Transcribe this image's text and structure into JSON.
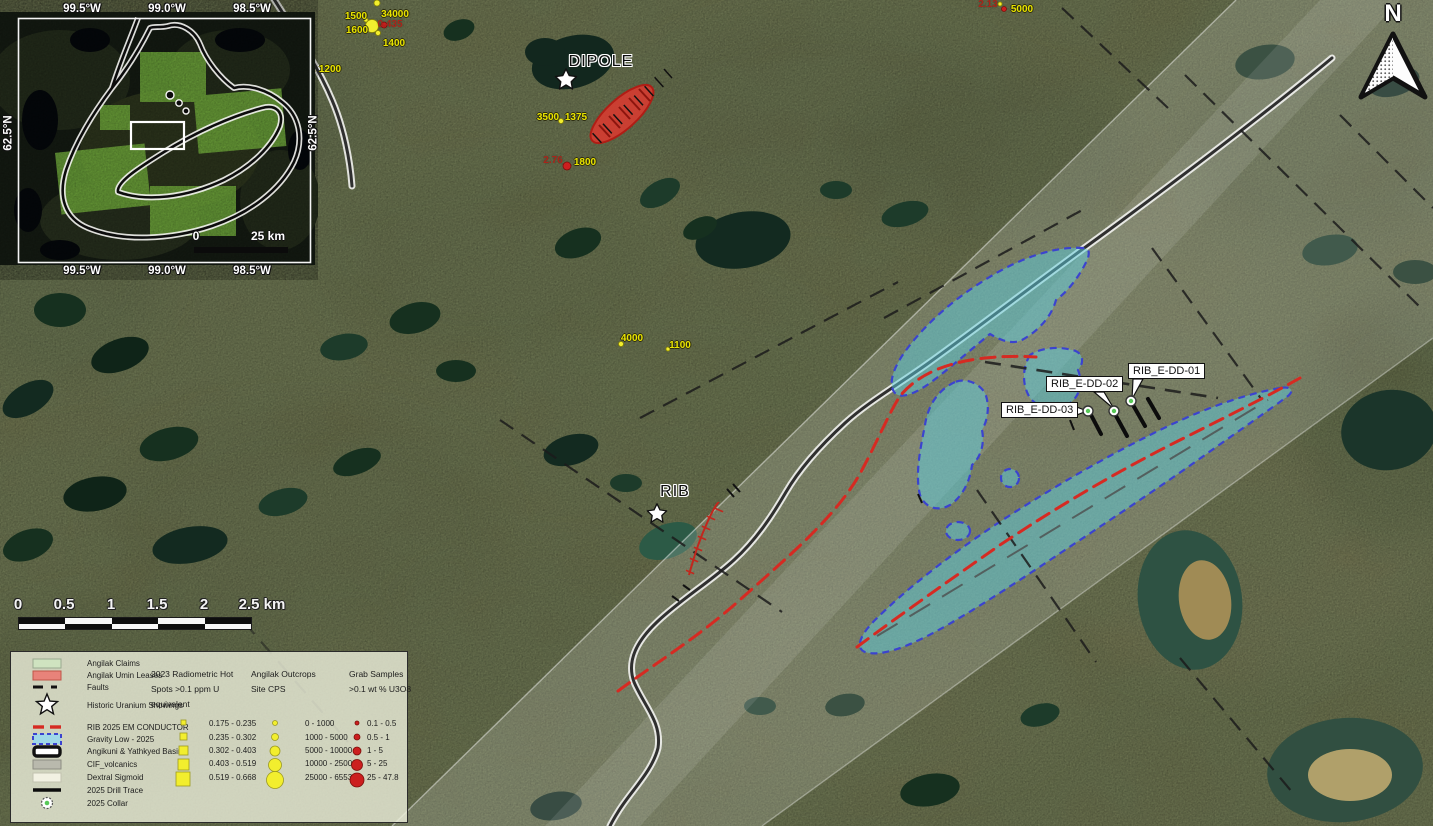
{
  "colors": {
    "terrain_base": "#7e8258",
    "gravity_low_fill": "#5ecedd",
    "gravity_low_border": "#3b43cf",
    "em_conductor_red": "#d62a22",
    "lease_red": "#d93a30",
    "claims_green": "#cfe3c0",
    "hotspot_yellow": "#f2ee2e",
    "grab_sample_red": "#cc1f1f",
    "collar_green": "#58c858",
    "fault_black": "#1c1c1c",
    "label_yellow": "#e9e400",
    "label_red": "#a8251a",
    "sigmoid_band_white": "#ffffff"
  },
  "north_arrow": {
    "label": "N"
  },
  "inset": {
    "top_labels": [
      "99.5°W",
      "99.0°W",
      "98.5°W"
    ],
    "bottom_labels": [
      "99.5°W",
      "99.0°W",
      "98.5°W"
    ],
    "left_label": "62.5°N",
    "right_label": "62.5°N",
    "scale_zero": "0",
    "scale_max": "25 km"
  },
  "places": [
    {
      "name": "DIPOLE"
    },
    {
      "name": "RIB"
    }
  ],
  "drill_holes": [
    {
      "label": "RIB_E-DD-01"
    },
    {
      "label": "RIB_E-DD-02"
    },
    {
      "label": "RIB_E-DD-03"
    }
  ],
  "point_labels": {
    "yellow": [
      "1500",
      "34000",
      "1600",
      "1400",
      "1200",
      "5000",
      "3500",
      "1375",
      "1800",
      "4000",
      "1100"
    ],
    "red": [
      "0.435",
      "2.13",
      "2.76"
    ]
  },
  "scalebar": {
    "ticks": [
      "0",
      "0.5",
      "1",
      "1.5",
      "2",
      "2.5 km"
    ]
  },
  "legend": {
    "overlays": [
      {
        "label": "Angilak Claims",
        "symbol": "claims-swatch"
      },
      {
        "label": "Angilak Umin Leases",
        "symbol": "leases-swatch"
      },
      {
        "label": "Faults",
        "symbol": "fault-dash"
      },
      {
        "label": "Historic Uranium Showings",
        "symbol": "star"
      },
      {
        "label": "RIB 2025 EM CONDUCTOR",
        "symbol": "red-dash"
      },
      {
        "label": "Gravity Low - 2025",
        "symbol": "gravity-swatch"
      },
      {
        "label": "Angikuni & Yathkyed Basins",
        "symbol": "basin-outline"
      },
      {
        "label": "CIF_volcanics",
        "symbol": "gray-swatch"
      },
      {
        "label": "Dextral Sigmoid",
        "symbol": "pale-swatch"
      },
      {
        "label": "2025 Drill Trace",
        "symbol": "black-line"
      },
      {
        "label": "2025 Collar",
        "symbol": "collar"
      }
    ],
    "radiometric": {
      "title_lines": [
        "2023 Radiometric Hot",
        "Spots >0.1 ppm U",
        "equivalent"
      ],
      "classes": [
        "0.175 - 0.235",
        "0.235 - 0.302",
        "0.302 - 0.403",
        "0.403 - 0.519",
        "0.519 - 0.668"
      ]
    },
    "outcrops": {
      "title_lines": [
        "Angilak Outcrops",
        "Site CPS"
      ],
      "classes": [
        "0 - 1000",
        "1000 - 5000",
        "5000 - 10000",
        "10000 - 25000",
        "25000 - 65535"
      ]
    },
    "grab_samples": {
      "title_lines": [
        "Grab Samples",
        ">0.1 wt % U3O8"
      ],
      "classes": [
        "0.1 - 0.5",
        "0.5 - 1",
        "1 - 5",
        "5 - 25",
        "25 - 47.8"
      ]
    }
  }
}
